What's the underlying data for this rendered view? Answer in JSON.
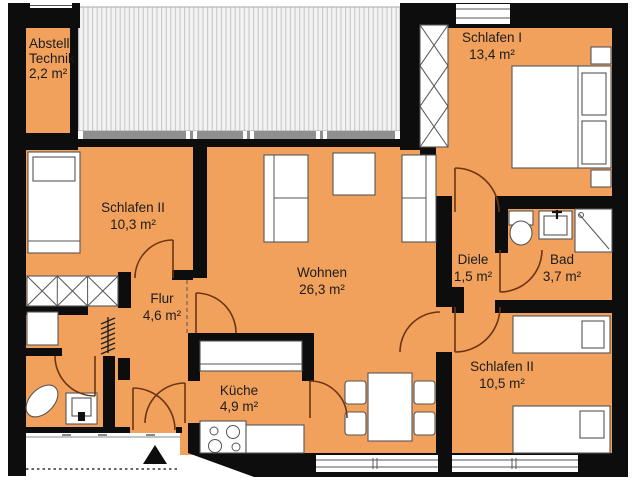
{
  "plan": {
    "type": "apartment-floor-plan",
    "colors": {
      "floor_fill": "#f2a15c",
      "wall": "#0d0d0d",
      "door_arc": "#6b3512",
      "terrace_stripe": "#c4c4c4",
      "glazing_band": "#8f8f8f"
    },
    "rooms": {
      "abstell": {
        "name_line1": "Abstell",
        "name_line2": "Technik",
        "area": "2,2 m²"
      },
      "schlafen1": {
        "name": "Schlafen I",
        "area": "13,4 m²"
      },
      "schlafen2_left": {
        "name": "Schlafen II",
        "area": "10,3 m²"
      },
      "wohnen": {
        "name": "Wohnen",
        "area": "26,3 m²"
      },
      "flur": {
        "name": "Flur",
        "area": "4,6 m²"
      },
      "diele": {
        "name": "Diele",
        "area": "1,5 m²"
      },
      "bad": {
        "name": "Bad",
        "area": "3,7 m²"
      },
      "schlafen2_right": {
        "name": "Schlafen II",
        "area": "10,5 m²"
      },
      "kueche": {
        "name": "Küche",
        "area": "4,9 m²"
      }
    }
  }
}
